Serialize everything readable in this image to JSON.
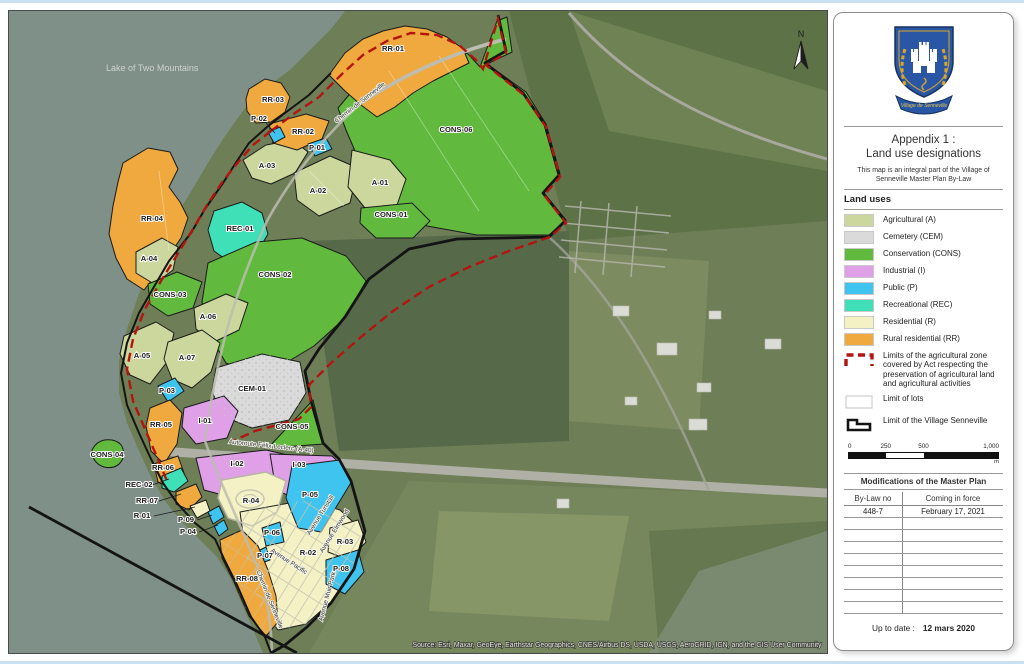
{
  "colors": {
    "agricultural": "#ccd79d",
    "cemetery": "#dadada",
    "conservation": "#61ba3e",
    "industrial": "#dfa0e8",
    "public": "#3ec4ee",
    "recreational": "#3fdfb7",
    "residential": "#f4f2c4",
    "rural": "#f0a93e",
    "agri_limit": "#b41410",
    "village_limit": "#141414",
    "lot_line": "#ffffff",
    "water": "#7e9088"
  },
  "map": {
    "water_label": "Lake of Two Mountains",
    "north_label": "N",
    "attribution": "Source: Esri, Maxar, GeoEye, Earthstar Geographics, CNES/Airbus DS, USDA, USGS, AeroGRID, IGN, and the GIS User Community",
    "zones": [
      {
        "label": "RR-01",
        "x": 384,
        "y": 40
      },
      {
        "label": "RR-03",
        "x": 264,
        "y": 91
      },
      {
        "label": "P-02",
        "x": 250,
        "y": 110
      },
      {
        "label": "RR-02",
        "x": 294,
        "y": 123
      },
      {
        "label": "P-01",
        "x": 308,
        "y": 139
      },
      {
        "label": "A-03",
        "x": 258,
        "y": 157
      },
      {
        "label": "A-02",
        "x": 309,
        "y": 182
      },
      {
        "label": "A-01",
        "x": 371,
        "y": 174
      },
      {
        "label": "CONS-06",
        "x": 447,
        "y": 121
      },
      {
        "label": "CONS-01",
        "x": 382,
        "y": 206
      },
      {
        "label": "REC-01",
        "x": 231,
        "y": 220
      },
      {
        "label": "RR-04",
        "x": 143,
        "y": 210
      },
      {
        "label": "A-04",
        "x": 140,
        "y": 250
      },
      {
        "label": "CONS-03",
        "x": 161,
        "y": 286
      },
      {
        "label": "CONS-02",
        "x": 266,
        "y": 266
      },
      {
        "label": "A-06",
        "x": 199,
        "y": 308
      },
      {
        "label": "A-05",
        "x": 133,
        "y": 347
      },
      {
        "label": "A-07",
        "x": 178,
        "y": 349
      },
      {
        "label": "P-03",
        "x": 158,
        "y": 382
      },
      {
        "label": "CEM-01",
        "x": 243,
        "y": 380
      },
      {
        "label": "I-01",
        "x": 196,
        "y": 412
      },
      {
        "label": "CONS-05",
        "x": 283,
        "y": 418
      },
      {
        "label": "RR-05",
        "x": 152,
        "y": 416
      },
      {
        "label": "CONS-04",
        "x": 98,
        "y": 446
      },
      {
        "label": "RR-06",
        "x": 154,
        "y": 459
      },
      {
        "label": "I-02",
        "x": 228,
        "y": 455
      },
      {
        "label": "I-03",
        "x": 290,
        "y": 456
      },
      {
        "label": "REC-02",
        "x": 130,
        "y": 476
      },
      {
        "label": "RR-07",
        "x": 138,
        "y": 492
      },
      {
        "label": "R-01",
        "x": 133,
        "y": 507
      },
      {
        "label": "P-09",
        "x": 177,
        "y": 511
      },
      {
        "label": "P-04",
        "x": 179,
        "y": 523
      },
      {
        "label": "R-04",
        "x": 242,
        "y": 492
      },
      {
        "label": "P-05",
        "x": 301,
        "y": 486
      },
      {
        "label": "P-06",
        "x": 263,
        "y": 524
      },
      {
        "label": "P-07",
        "x": 256,
        "y": 547
      },
      {
        "label": "R-02",
        "x": 299,
        "y": 544
      },
      {
        "label": "R-03",
        "x": 336,
        "y": 533
      },
      {
        "label": "P-08",
        "x": 332,
        "y": 560
      },
      {
        "label": "RR-08",
        "x": 238,
        "y": 570
      }
    ],
    "streets": [
      {
        "label": "Chemin de Senneville",
        "x": 352,
        "y": 93,
        "rot": -38
      },
      {
        "label": "Autoroute Félix-Leclerc (A-40)",
        "x": 262,
        "y": 437,
        "rot": 6
      },
      {
        "label": "Avenue Tunstall",
        "x": 313,
        "y": 505,
        "rot": -58
      },
      {
        "label": "Avenue Elmwood",
        "x": 327,
        "y": 521,
        "rot": -58
      },
      {
        "label": "Avenue Pacific",
        "x": 279,
        "y": 552,
        "rot": 33
      },
      {
        "label": "Chemin de Senneville",
        "x": 259,
        "y": 589,
        "rot": 68
      },
      {
        "label": "Avenue Muir Park",
        "x": 320,
        "y": 586,
        "rot": -75
      }
    ]
  },
  "panel": {
    "crest_banner": "Village de Senneville",
    "title_line1": "Appendix 1 :",
    "title_line2": "Land use designations",
    "subtitle": "This map is an integral part of the Village of Senneville Master Plan By-Law",
    "land_uses_heading": "Land uses",
    "legend": [
      {
        "cat": "agricultural",
        "label": "Agricultural (A)",
        "type": "fill"
      },
      {
        "cat": "cemetery",
        "label": "Cemetery (CEM)",
        "type": "fill"
      },
      {
        "cat": "conservation",
        "label": "Conservation (CONS)",
        "type": "fill"
      },
      {
        "cat": "industrial",
        "label": "Industrial (I)",
        "type": "fill"
      },
      {
        "cat": "public",
        "label": "Public (P)",
        "type": "fill"
      },
      {
        "cat": "recreational",
        "label": "Recreational (REC)",
        "type": "fill"
      },
      {
        "cat": "residential",
        "label": "Residential (R)",
        "type": "fill"
      },
      {
        "cat": "rural",
        "label": "Rural residential (RR)",
        "type": "fill"
      },
      {
        "cat": "agri_limit",
        "label": "Limits of the agricultural zone covered by Act respecting the preservation of agricultural land and agricultural activities",
        "type": "dashed"
      },
      {
        "cat": "lot_line",
        "label": "Limit of lots",
        "type": "lots"
      },
      {
        "cat": "village_limit",
        "label": "Limit of the Village Senneville",
        "type": "village"
      }
    ],
    "scalebar": {
      "ticks": [
        "0",
        "250",
        "500",
        "1,000"
      ],
      "unit": "m"
    },
    "modifications": {
      "title": "Modifications of the Master Plan",
      "columns": [
        "By-Law no",
        "Coming in force"
      ],
      "rows": [
        [
          "448-7",
          "February 17, 2021"
        ]
      ],
      "empty_rows": 8
    },
    "up_to_date_label": "Up to date :",
    "up_to_date_value": "12 mars 2020"
  }
}
